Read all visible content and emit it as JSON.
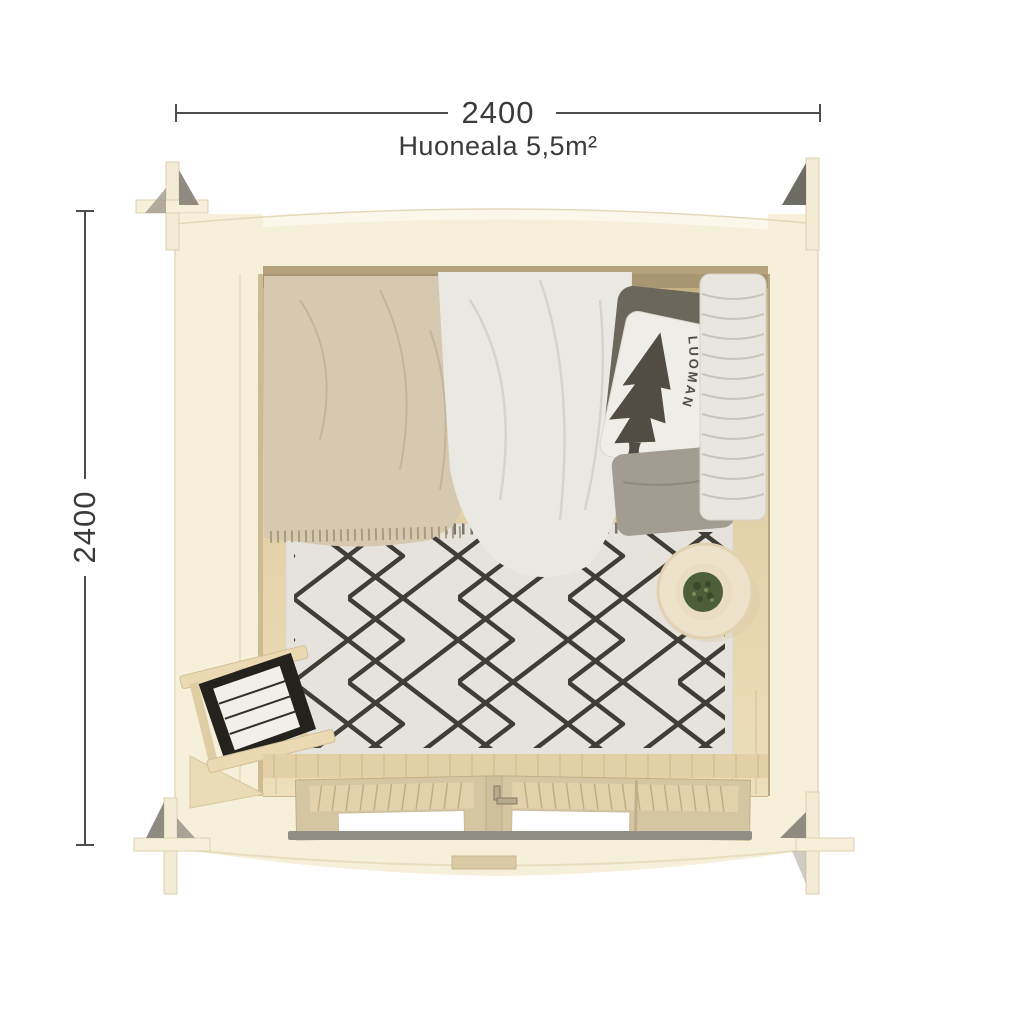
{
  "dimensions": {
    "width_label": "2400",
    "height_label": "2400",
    "area_label": "Huoneala 5,5m²"
  },
  "branding": {
    "pillow_logo": "LUOMAN"
  },
  "colors": {
    "background": "#ffffff",
    "dimension_line": "#4c4c4c",
    "dimension_text": "#3b3b3b",
    "wall": "#f6efda",
    "wall_highlight": "#fbf7ea",
    "wall_edge": "#ddd2b2",
    "log_end_gray": "#8f8b80",
    "floor_light": "#eadcb8",
    "floor_dark": "#c5ae83",
    "plank_line": "#d3bd92",
    "blanket": "#d6c9af",
    "duvet": "#eae8e2",
    "pillow_dark": "#6b675b",
    "pillow_gray": "#a29d90",
    "pillow_white": "#efede7",
    "logo_ink": "#514d43",
    "quilt": "#e9e6df",
    "rug": "#e6e3dc",
    "rug_line": "#3e3d36",
    "table": "#eee2ca",
    "plant": "#4d5f38",
    "door_wood": "#d5c6a3",
    "door_slat": "#e2d3ae",
    "window": "#ffffff",
    "threshold": "#908e85",
    "towel_dark": "#24221d",
    "towel_light": "#f1efe9"
  }
}
